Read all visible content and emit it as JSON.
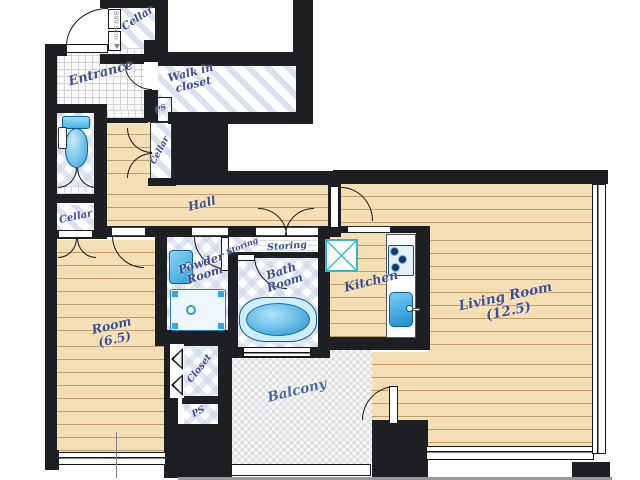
{
  "page": {
    "type": "apartment-floor-plan"
  },
  "colors": {
    "wall": "#1e1f22",
    "wood_floor": "#f4deb4",
    "wood_grain": "#c69e66",
    "label_text": "#3d4f8a",
    "dimension_text": "#8a8a8a",
    "fixture_blue": "#36a9e0",
    "fixture_outline": "#0d5e92",
    "wet_tile_blue": "#dbe0ef",
    "balcony_check_gray": "#e0e0e0",
    "appliance_teal": "#35b6c9"
  },
  "rooms": {
    "entrance": {
      "label": "Entrance"
    },
    "walk_in_closet": {
      "line1": "Walk in",
      "line2": "closet"
    },
    "cellar_top": {
      "label": "Cellar",
      "dimension": "B99.5cm"
    },
    "cellar_mid": {
      "label": "Cellar"
    },
    "cellar_left": {
      "label": "Cellar"
    },
    "ps_top": {
      "label": "PS"
    },
    "ps_bottom": {
      "label": "PS"
    },
    "hall": {
      "label": "Hall"
    },
    "powder_room": {
      "line1": "Powder",
      "line2": "Room"
    },
    "storing_left": {
      "label": "Storing"
    },
    "storing_right": {
      "label": "Storing"
    },
    "bath_room": {
      "line1": "Bath",
      "line2": "Room"
    },
    "kitchen": {
      "label": "Kitchen"
    },
    "living_room": {
      "line1": "Living Room",
      "line2": "(12.5)"
    },
    "room": {
      "line1": "Room",
      "line2": "(6.5)"
    },
    "closet": {
      "label": "Closet"
    },
    "balcony": {
      "label": "Balcony"
    }
  }
}
